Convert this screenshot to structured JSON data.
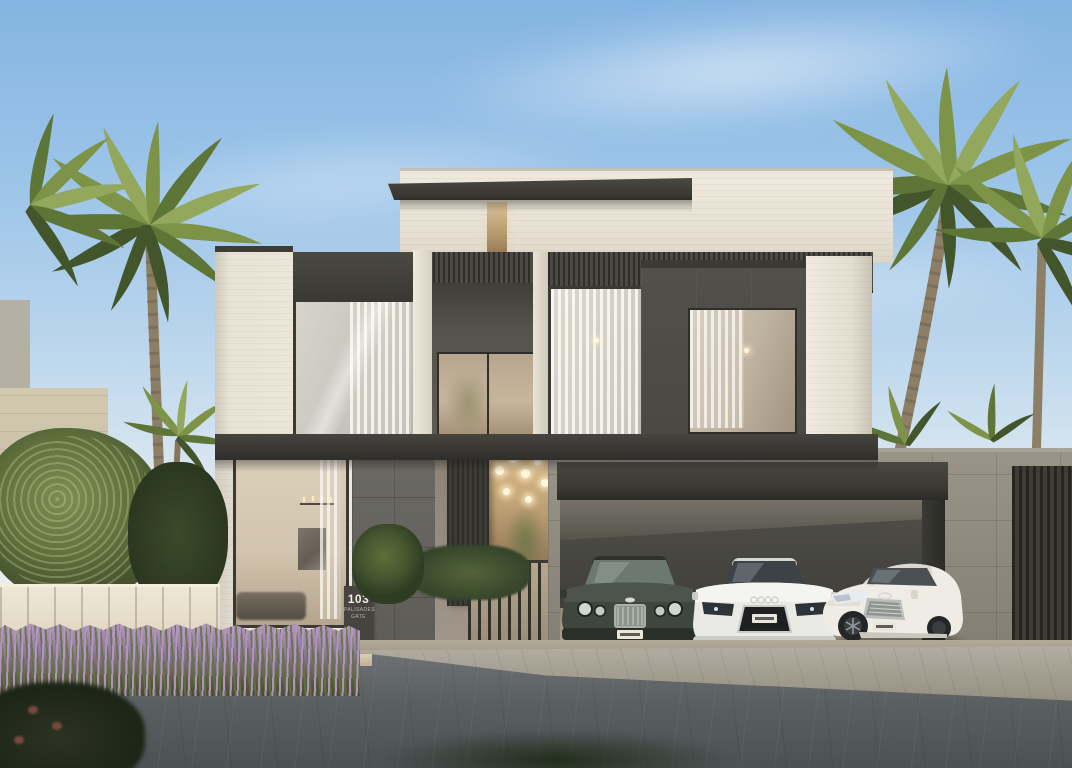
{
  "scene": {
    "type": "architectural-exterior-rendering",
    "description": "Modern two-storey luxury villa with white stone and dark bronze facade, triple-car garage, entrance gate, palm trees and lavender hedge under a clear blue sky",
    "time_of_day": "day"
  },
  "address_sign": {
    "number": "103",
    "line1": "PALISADES",
    "line2": "GATE"
  },
  "villa": {
    "storeys": 2,
    "materials": [
      "white brick stone",
      "dark bronze metal panels",
      "grey basalt tile",
      "beige stone tile",
      "glass"
    ]
  },
  "cars": [
    {
      "id": "car-coupe-dark",
      "kind": "dark green grand-tourer coupe",
      "body_color": "#3f463e",
      "plate_color": "#e9e6dc"
    },
    {
      "id": "car-sports-white",
      "kind": "white mid-engine sports car",
      "body_color": "#e9e9e6",
      "plate_color": "#e9e6dc"
    },
    {
      "id": "car-sedan-white",
      "kind": "white luxury sedan",
      "body_color": "#efece5",
      "plate_color": "#e9e6dc"
    }
  ],
  "landscape": {
    "palm_trees_left": 3,
    "palm_trees_right": 3,
    "hedge": "lavender",
    "fence": "cream vertical-slat fence"
  },
  "colors": {
    "sky_top": "#85b4e2",
    "sky_horizon": "#eceeea",
    "facade_white": "#ece6d9",
    "panel_dark": "#3a3934",
    "garage_stone": "#8d887c",
    "basalt_pier": "#5d5c56",
    "glass_warm": "#c7b69c",
    "fence_cream": "#e9e1d1",
    "lavender": "#a98bb0",
    "palm_green": "#7d9348",
    "road": "#565b5e",
    "apron": "#9d978a"
  }
}
